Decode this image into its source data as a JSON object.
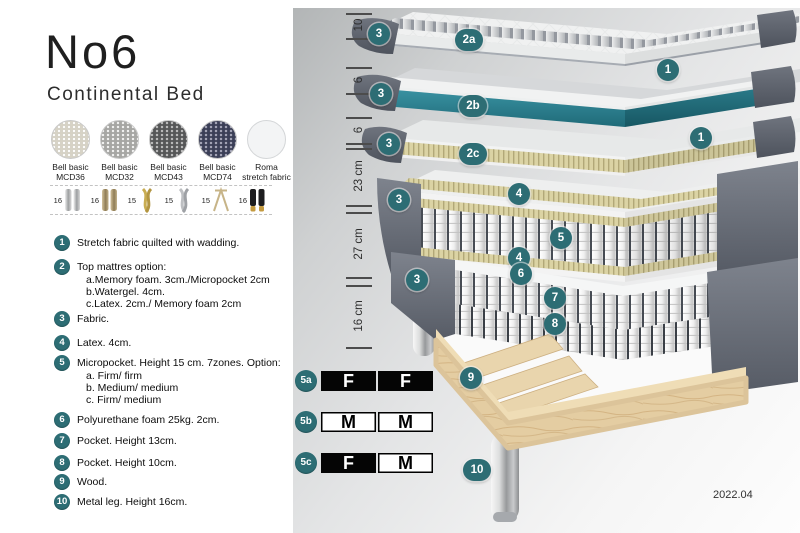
{
  "page": {
    "title": "No6",
    "subtitle": "Continental Bed",
    "date": "2022.04"
  },
  "fabrics": [
    {
      "line1": "Bell basic",
      "line2": "MCD36",
      "color": "#d7d3c6"
    },
    {
      "line1": "Bell basic",
      "line2": "MCD32",
      "color": "#a7a7a4"
    },
    {
      "line1": "Bell basic",
      "line2": "MCD43",
      "color": "#565758"
    },
    {
      "line1": "Bell basic",
      "line2": "MCD74",
      "color": "#3b3f58"
    },
    {
      "line1": "Roma",
      "line2": "stretch fabric",
      "color": "#f3f4f5"
    }
  ],
  "legs": {
    "options": [
      {
        "height": "16",
        "type": "cylinder-chrome"
      },
      {
        "height": "16",
        "type": "cylinder-wood"
      },
      {
        "height": "15",
        "type": "twisted-gold"
      },
      {
        "height": "15",
        "type": "twisted-silver"
      },
      {
        "height": "15",
        "type": "hairpin-metal"
      },
      {
        "height": "16",
        "type": "cylinder-black-gold"
      }
    ]
  },
  "legend": [
    {
      "num": "1",
      "text": "Stretch fabric quilted with wadding.",
      "subs": []
    },
    {
      "num": "2",
      "text": "Top mattres option:",
      "subs": [
        "a.Memory foam. 3cm./Micropocket 2cm",
        "b.Watergel. 4cm.",
        "c.Latex. 2cm./ Memory foam 2cm"
      ]
    },
    {
      "num": "3",
      "text": "Fabric.",
      "subs": []
    },
    {
      "num": "4",
      "text": "Latex. 4cm.",
      "subs": []
    },
    {
      "num": "5",
      "text": "Micropocket. Height 15 cm. 7zones. Option:",
      "subs": [
        "a. Firm/ firm",
        "b. Medium/ medium",
        "c. Firm/ medium"
      ]
    },
    {
      "num": "6",
      "text": "Polyurethane foam 25kg. 2cm.",
      "subs": []
    },
    {
      "num": "7",
      "text": "Pocket. Height 13cm.",
      "subs": []
    },
    {
      "num": "8",
      "text": "Pocket. Height 10cm.",
      "subs": []
    },
    {
      "num": "9",
      "text": "Wood.",
      "subs": []
    },
    {
      "num": "10",
      "text": "Metal leg. Height 16cm.",
      "subs": []
    }
  ],
  "ruler": {
    "segments": [
      "10",
      "6",
      "6",
      "23 cm",
      "27 cm",
      "16 cm"
    ]
  },
  "callouts": [
    {
      "label": "3"
    },
    {
      "label": "2a"
    },
    {
      "label": "1"
    },
    {
      "label": "3"
    },
    {
      "label": "2b"
    },
    {
      "label": "3"
    },
    {
      "label": "2c"
    },
    {
      "label": "1"
    },
    {
      "label": "4"
    },
    {
      "label": "3"
    },
    {
      "label": "5"
    },
    {
      "label": "4"
    },
    {
      "label": "6"
    },
    {
      "label": "7"
    },
    {
      "label": "3"
    },
    {
      "label": "8"
    },
    {
      "label": "9"
    },
    {
      "label": "10"
    }
  ],
  "firmness": {
    "rows": [
      {
        "label": "5a",
        "cells": [
          {
            "letter": "F",
            "variant": "dark"
          },
          {
            "letter": "F",
            "variant": "dark"
          }
        ]
      },
      {
        "label": "5b",
        "cells": [
          {
            "letter": "M",
            "variant": "light"
          },
          {
            "letter": "M",
            "variant": "light"
          }
        ]
      },
      {
        "label": "5c",
        "cells": [
          {
            "letter": "F",
            "variant": "dark"
          },
          {
            "letter": "M",
            "variant": "light"
          }
        ]
      }
    ]
  },
  "colors": {
    "accent_teal": "#2d6d74",
    "watergel_teal": "#2f7f8f",
    "fabric_gray": "#6a6f79",
    "latex_tan": "#d9d1a4",
    "wood": "#e4cda2"
  }
}
